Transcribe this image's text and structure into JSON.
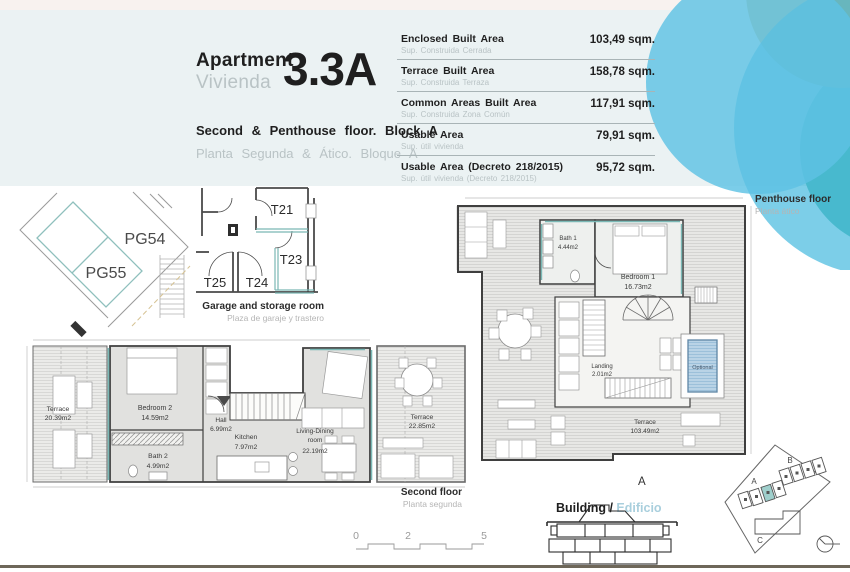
{
  "header": {
    "title_en": "Apartment",
    "title_es": "Vivienda",
    "unit": "3.3A",
    "subtitle_en": "Second & Penthouse floor. Block A",
    "subtitle_es": "Planta Segunda & Ático. Bloque A"
  },
  "areas": {
    "rows": [
      {
        "label_en": "Enclosed Built Area",
        "label_es": "Sup. Construida Cerrada",
        "value": "103,49 sqm."
      },
      {
        "label_en": "Terrace Built Area",
        "label_es": "Sup. Construida Terraza",
        "value": "158,78 sqm."
      },
      {
        "label_en": "Common Areas Built Area",
        "label_es": "Sup. Construida Zona Común",
        "value": "117,91 sqm."
      },
      {
        "label_en": "Usable Area",
        "label_es": "Sup. útil vivienda",
        "value": "79,91 sqm."
      },
      {
        "label_en": "Usable Area (Decreto 218/2015)",
        "label_es": "Sup. útil vivienda (Decreto 218/2015)",
        "value": "95,72 sqm."
      }
    ]
  },
  "garage": {
    "pg54": "PG54",
    "pg55": "PG55",
    "t21": "T21",
    "t23": "T23",
    "t24": "T24",
    "t25": "T25",
    "caption_en": "Garage and storage room",
    "caption_es": "Plaza de garaje y trastero"
  },
  "second_floor": {
    "caption_en": "Second floor",
    "caption_es": "Planta segunda",
    "terrace_left_name": "Terrace",
    "terrace_left_area": "20.39m2",
    "bedroom2_name": "Bedroom 2",
    "bedroom2_area": "14.59m2",
    "bath2_name": "Bath 2",
    "bath2_area": "4.99m2",
    "hall_name": "Hall",
    "hall_area": "6.99m2",
    "kitchen_name": "Kitchen",
    "kitchen_area": "7.97m2",
    "living_name1": "Living-Dining",
    "living_name2": "room",
    "living_area": "22.19m2",
    "terrace_right_name": "Terrace",
    "terrace_right_area": "22.85m2"
  },
  "penthouse": {
    "caption_en": "Penthouse floor",
    "caption_es": "Planta ático",
    "bath1_name": "Bath 1",
    "bath1_area": "4.44m2",
    "bedroom1_name": "Bedroom 1",
    "bedroom1_area": "16.73m2",
    "landing_name": "Landing",
    "landing_area": "2.01m2",
    "terrace_name": "Terrace",
    "terrace_area": "103.49m2",
    "optional": "Optional",
    "block_letter": "A"
  },
  "scale_bar": {
    "ticks": [
      "0",
      "2",
      "5"
    ]
  },
  "building": {
    "label_en": "Building /",
    "label_es": "Edificio"
  },
  "site_plan": {
    "blocks": [
      "A",
      "B",
      "C"
    ]
  },
  "colors": {
    "accent_teal": "#7ab8b5",
    "pool_blue": "#b9d3e6",
    "deco_blue_light": "#5ec2e4",
    "deco_blue_dark": "#24aed8",
    "deco_khaki": "#cec293",
    "deco_teal": "#7ecabe",
    "highlight_unit": "#9fcfcc",
    "header_bg": "#ebf2f3"
  }
}
